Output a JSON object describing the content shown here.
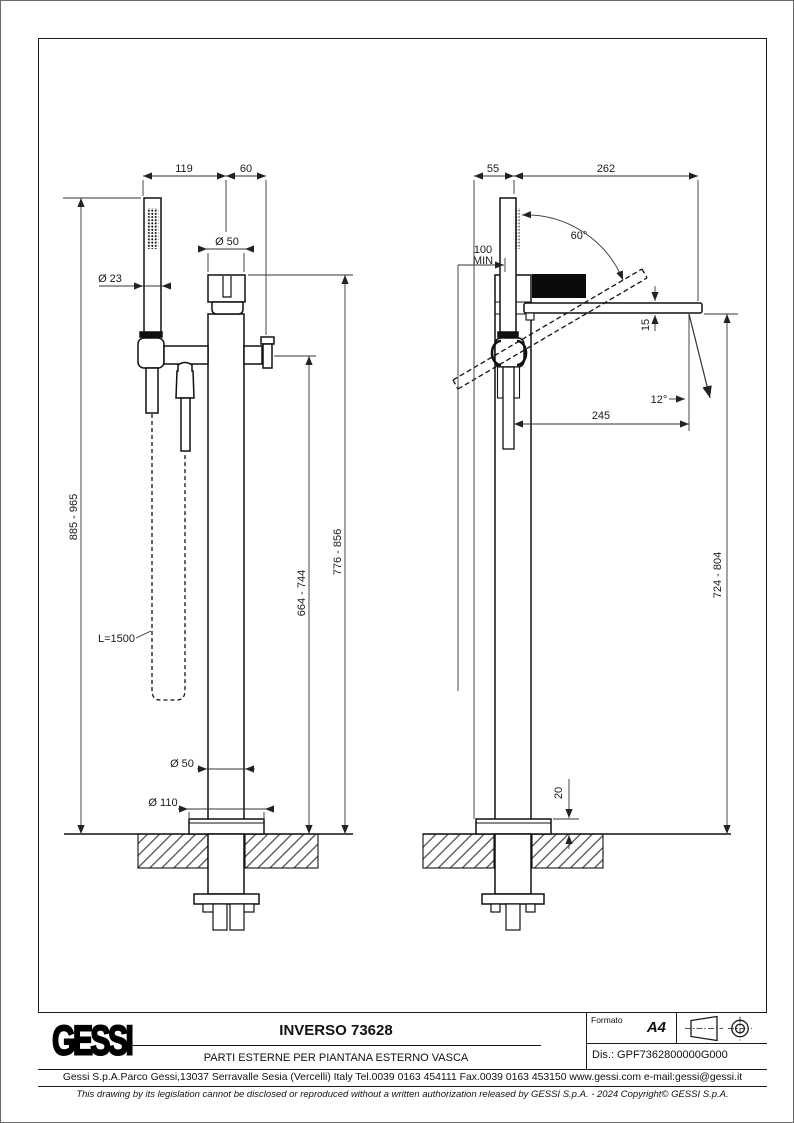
{
  "colors": {
    "ink": "#1a1a1a",
    "paper": "#ffffff"
  },
  "front_view": {
    "dim_119": "119",
    "dim_60": "60",
    "dia_50_top": "Ø 50",
    "dia_23": "Ø 23",
    "overall_height": "885 - 965",
    "spout_top_height": "776 - 856",
    "outlet_height": "664 - 744",
    "hose_length": "L=1500",
    "dia_50_bottom": "Ø 50",
    "dia_110": "Ø 110"
  },
  "side_view": {
    "dim_55": "55",
    "dim_262": "262",
    "min_clearance_value": "100",
    "min_clearance_label": "MIN",
    "angle_60": "60°",
    "dim_15": "15",
    "angle_12": "12°",
    "dim_245": "245",
    "height_724_804": "724 - 804",
    "base_plate_20": "20"
  },
  "title_block": {
    "logo": "GESSI",
    "title": "INVERSO 73628",
    "subtitle": "PARTI ESTERNE PER PIANTANA ESTERNO VASCA",
    "format_label": "Formato",
    "format_value": "A4",
    "drawing_number": "Dis.: GPF7362800000G000",
    "address": "Gessi S.p.A.Parco Gessi,13037 Serravalle Sesia (Vercelli) Italy Tel.0039 0163 454111 Fax.0039 0163 453150 www.gessi.com e-mail:gessi@gessi.it",
    "copyright": "This drawing by its legislation cannot be disclosed or reproduced without a written authorization released by GESSI S.p.A. - 2024 Copyright© GESSI S.p.A."
  }
}
